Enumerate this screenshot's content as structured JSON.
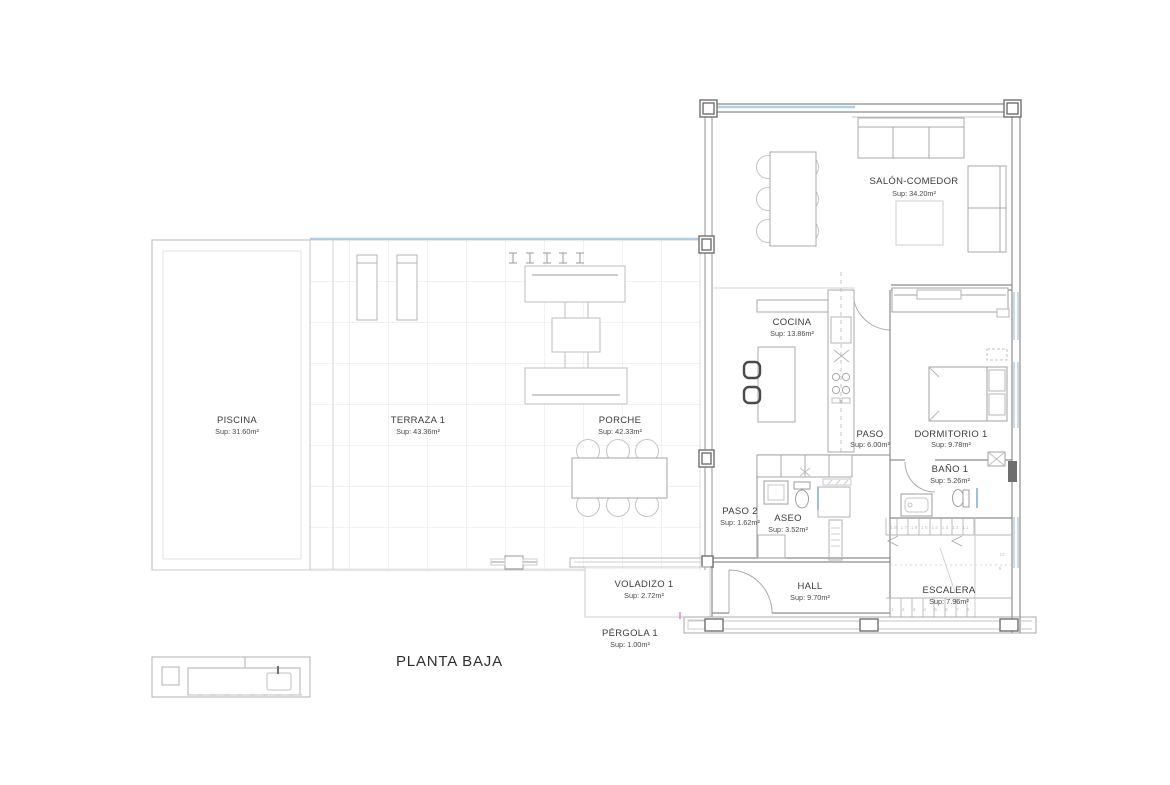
{
  "plan": {
    "title": "PLANTA BAJA",
    "drawing_type": "floor-plan"
  },
  "rooms": [
    {
      "name": "PISCINA",
      "area": "Sup: 31.60m²"
    },
    {
      "name": "TERRAZA 1",
      "area": "Sup: 43.36m²"
    },
    {
      "name": "PORCHE",
      "area": "Sup: 42.33m²"
    },
    {
      "name": "SALÓN-COMEDOR",
      "area": "Sup: 34.20m²"
    },
    {
      "name": "COCINA",
      "area": "Sup: 13.86m²"
    },
    {
      "name": "PASO",
      "area": "Sup: 6.00m²"
    },
    {
      "name": "DORMITORIO 1",
      "area": "Sup: 9.78m²"
    },
    {
      "name": "BAÑO 1",
      "area": "Sup: 5.26m²"
    },
    {
      "name": "PASO 2",
      "area": "Sup: 1.62m²"
    },
    {
      "name": "ASEO",
      "area": "Sup: 3.52m²"
    },
    {
      "name": "VOLADIZO 1",
      "area": "Sup: 2.72m²"
    },
    {
      "name": "HALL",
      "area": "Sup: 9.70m²"
    },
    {
      "name": "ESCALERA",
      "area": "Sup: 7.96m²"
    },
    {
      "name": "PÉRGOLA 1",
      "area": "Sup: 1.00m²"
    }
  ],
  "stairs": {
    "upper_steps": "18 17 16 15 14 13 12 11",
    "lower_steps": "1 2 3 4 5 6 7 8",
    "landing_a": "10",
    "landing_b": "9"
  },
  "colors": {
    "wall": "#8c8c8c",
    "furniture": "#b5b5b5",
    "glazing": "#aed0e4",
    "grid": "#e5e5e5",
    "text": "#3c3c3c",
    "accent_pink": "#d668c8"
  }
}
